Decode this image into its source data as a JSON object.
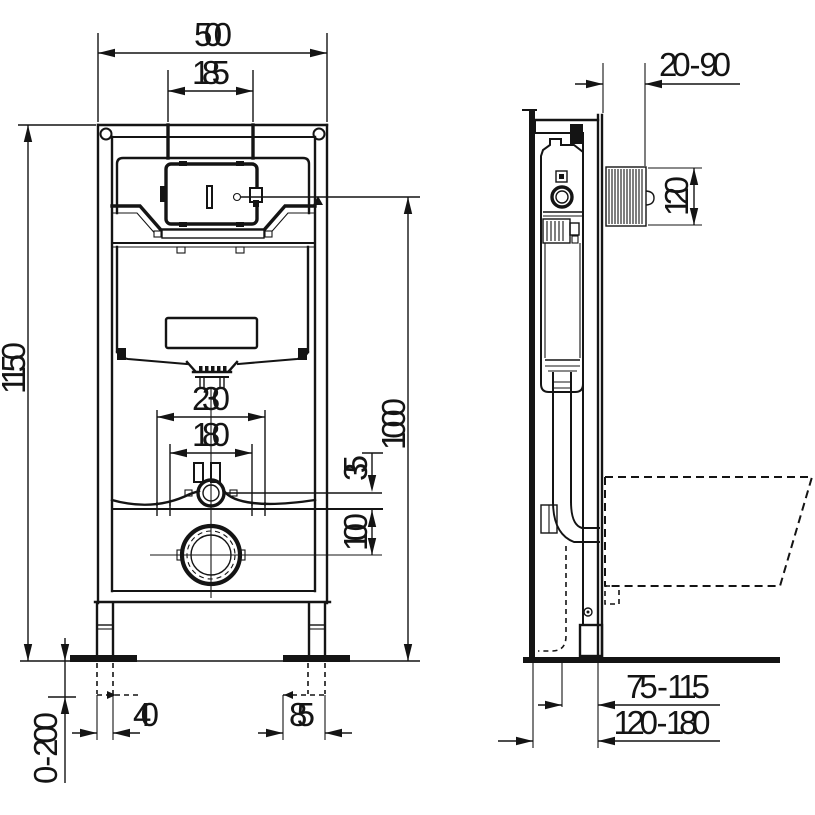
{
  "colors": {
    "line": "#141414",
    "background": "#ffffff"
  },
  "front": {
    "dims": {
      "overall_width": "500",
      "plate_cutout_width": "185",
      "overall_height": "1150",
      "plate_height": "1000",
      "fixing_outer_spacing": "230",
      "fixing_inner_spacing": "180",
      "inlet_above_fixings": "35",
      "fixings_above_outlet": "100",
      "left_foot_offset": "40",
      "right_foot_offset": "85",
      "foot_adjustment": "0 - 200"
    }
  },
  "side": {
    "dims": {
      "wall_finish_range": "20 - 90",
      "plate_opening_height": "120",
      "outlet_to_frame": "75 - 115",
      "outlet_to_wall": "120 - 180"
    }
  }
}
